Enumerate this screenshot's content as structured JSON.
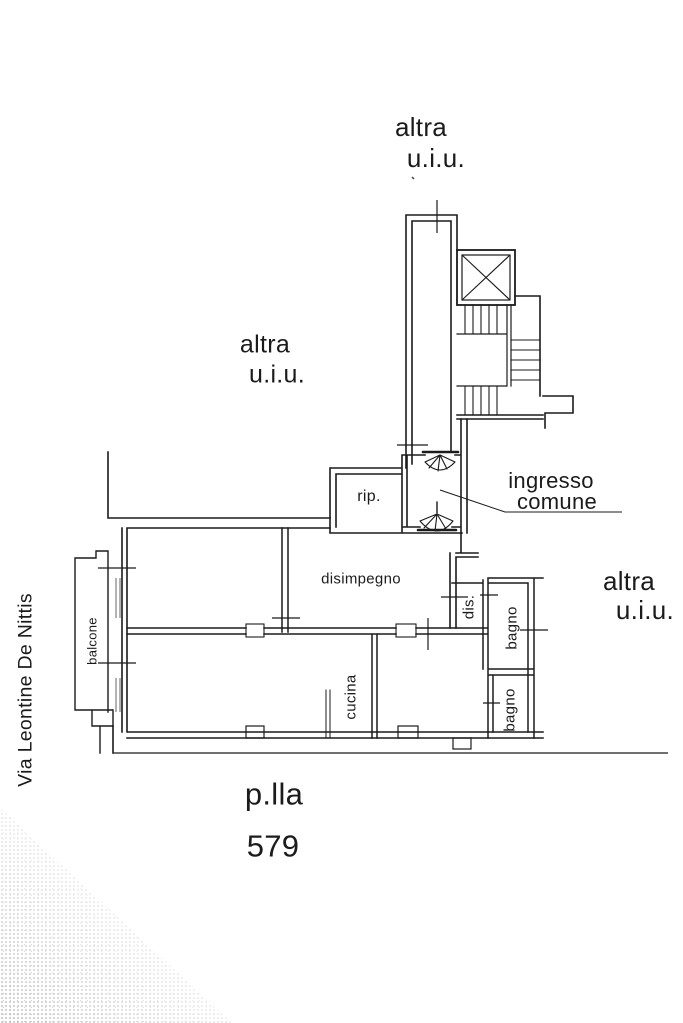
{
  "labels": {
    "neighbor_top": {
      "line1": "altra",
      "line2": "u.i.u."
    },
    "neighbor_left": {
      "line1": "altra",
      "line2": "u.i.u."
    },
    "neighbor_right": {
      "line1": "altra",
      "line2": "u.i.u."
    },
    "common_entrance": {
      "line1": "ingresso",
      "line2": "comune"
    },
    "street": "Via Leontine De Nittis",
    "parcel_prefix": "p.lla",
    "parcel_number": "579"
  },
  "rooms": {
    "storage": "rip.",
    "hallway": "disimpegno",
    "toilet": "dis.",
    "bathroom_upper": "bagno",
    "bathroom_lower": "bagno",
    "kitchen": "cucina",
    "balcony": "balcone"
  },
  "colors": {
    "ink": "#1b1b1b",
    "paper": "#ffffff"
  }
}
